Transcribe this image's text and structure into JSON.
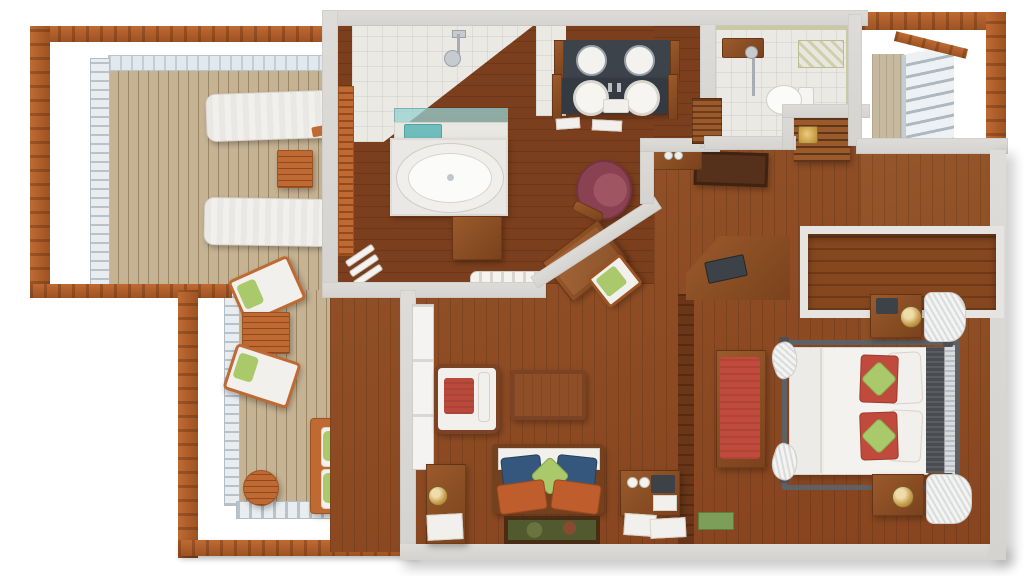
{
  "meta": {
    "title": "Hotel suite 3D floor plan - top-down render",
    "view": "top-down axonometric",
    "background": "white"
  },
  "palette": {
    "wall": "#d5d3cf",
    "floor": "#95562a",
    "floor-2": "#87441f",
    "floor-dark": "#7b3f1d",
    "balcony": "#c6b394",
    "pergola": "#bf6a33",
    "pergola-dark": "#9c5322",
    "rail-bg": "#e9edf0",
    "rail-slat": "#b7c2cb",
    "tile": "#ebe9e4",
    "white-furn": "#f2f0ec",
    "counter": "#3d434a",
    "wood-furn": "#9a5a2b",
    "wood-furn-dark": "#7a421d",
    "gold": "#c79b4a",
    "tv": "#3c4248",
    "beige": "#c6b99f",
    "teal": "#6fbdbd",
    "red": "#c04a3c",
    "maroon": "#8a4152",
    "green": "#a9c96b",
    "blue": "#35577d",
    "orange": "#bf5e2c",
    "bedframe": "#5d6064",
    "headboard": "#494c51",
    "divider": "#6b3518",
    "mat": "#55301a"
  },
  "rooms": [
    {
      "id": "balcony-left",
      "label": "Wraparound balcony with pergola"
    },
    {
      "id": "bathroom",
      "label": "Bathroom with soaking tub"
    },
    {
      "id": "vanity",
      "label": "Double vanity"
    },
    {
      "id": "shower-room",
      "label": "Shower and toilet room"
    },
    {
      "id": "entry",
      "label": "Entry hall"
    },
    {
      "id": "living-room",
      "label": "Living room"
    },
    {
      "id": "bedroom",
      "label": "Bedroom"
    },
    {
      "id": "balcony-rear",
      "label": "Rear balcony"
    }
  ],
  "furniture": {
    "balcony": [
      "sun lounger",
      "sun lounger",
      "slatted side table",
      "deck chair with green cushion",
      "deck chair with green cushion",
      "slatted coffee table",
      "loveseat with green pillows",
      "side table",
      "round bistro table"
    ],
    "bathroom": [
      "oval jetted tub on platform",
      "glass shelf",
      "teal towel",
      "wood stool",
      "towel ladder",
      "rolled towels",
      "rain shower",
      "double vessel-sink vanity",
      "round mirrors"
    ],
    "shower_room": [
      "toilet",
      "handheld shower",
      "striped bath mat"
    ],
    "entry": [
      "louvered closet",
      "doormat",
      "console with glasses"
    ],
    "hall": [
      "barrel chair",
      "writing desk",
      "desk chair with green cushion"
    ],
    "living_room": [
      "armchair with red cushion",
      "coffee table",
      "sofa with blue and green pillows",
      "floor artwork",
      "writing desk with lamp",
      "minibar cabinet",
      "papers",
      "green magazine"
    ],
    "bedroom": [
      "four-poster bed",
      "white duvet",
      "red pillows",
      "green accent pillows",
      "striped headboard",
      "red bench",
      "nightstand with lamp",
      "nightstand with lamp",
      "white drapes",
      "wardrobe",
      "corner TV console"
    ]
  }
}
